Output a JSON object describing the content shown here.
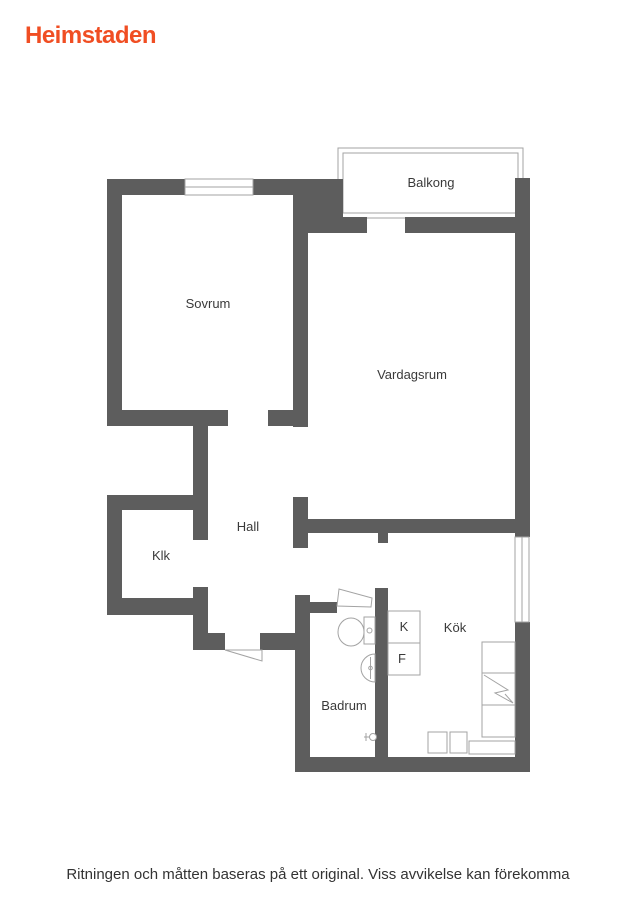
{
  "logo": {
    "text": "Heimstaden",
    "color": "#f04e23"
  },
  "floorplan": {
    "rooms": [
      {
        "id": "balkong",
        "label": "Balkong"
      },
      {
        "id": "sovrum",
        "label": "Sovrum"
      },
      {
        "id": "vardagsrum",
        "label": "Vardagsrum"
      },
      {
        "id": "hall",
        "label": "Hall"
      },
      {
        "id": "klk",
        "label": "Klk"
      },
      {
        "id": "badrum",
        "label": "Badrum"
      },
      {
        "id": "kok",
        "label": "Kök"
      }
    ],
    "appliances": [
      {
        "id": "kylskap",
        "label": "K"
      },
      {
        "id": "frys",
        "label": "F"
      }
    ],
    "colors": {
      "wall": "#5d5d5d",
      "outline": "#a3a3a3",
      "text": "#3a3a3a"
    }
  },
  "footer": {
    "disclaimer": "Ritningen och måtten baseras på ett original. Viss avvikelse kan förekomma"
  }
}
